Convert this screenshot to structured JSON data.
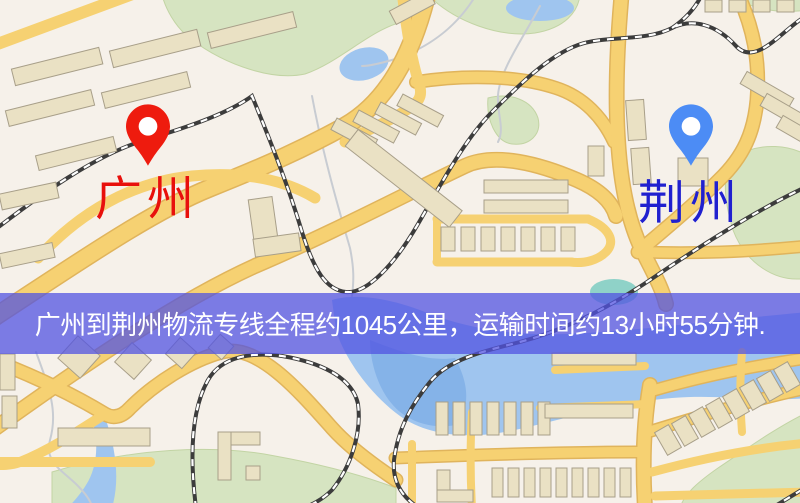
{
  "banner": {
    "text": "广州到荆州物流专线全程约1045公里，运输时间约13小时55分钟."
  },
  "markers": {
    "origin": {
      "label": "广州",
      "pin_color": "#ee1b0e",
      "label_color": "#e8100c"
    },
    "destination": {
      "label": "荆州",
      "pin_color": "#4c8cf5",
      "label_color": "#2020cf"
    }
  },
  "colors": {
    "banner-overlay": "rgba(82,83,225,0.75)",
    "banner-text": "#ffffff",
    "map-base": "#f6f1ea",
    "road-fill": "#f6d172",
    "road-casing": "#e0b45c",
    "water": "#9fc5ef",
    "water-deep": "#85b3e8",
    "green": "#d6e4c1",
    "teal": "#8fd2c8",
    "building": "#eae1c4",
    "building-outline": "#a89f89",
    "rail-dark": "#3c3c3c",
    "rail-light": "#ffffff",
    "path-gray": "#c8ccd2"
  }
}
